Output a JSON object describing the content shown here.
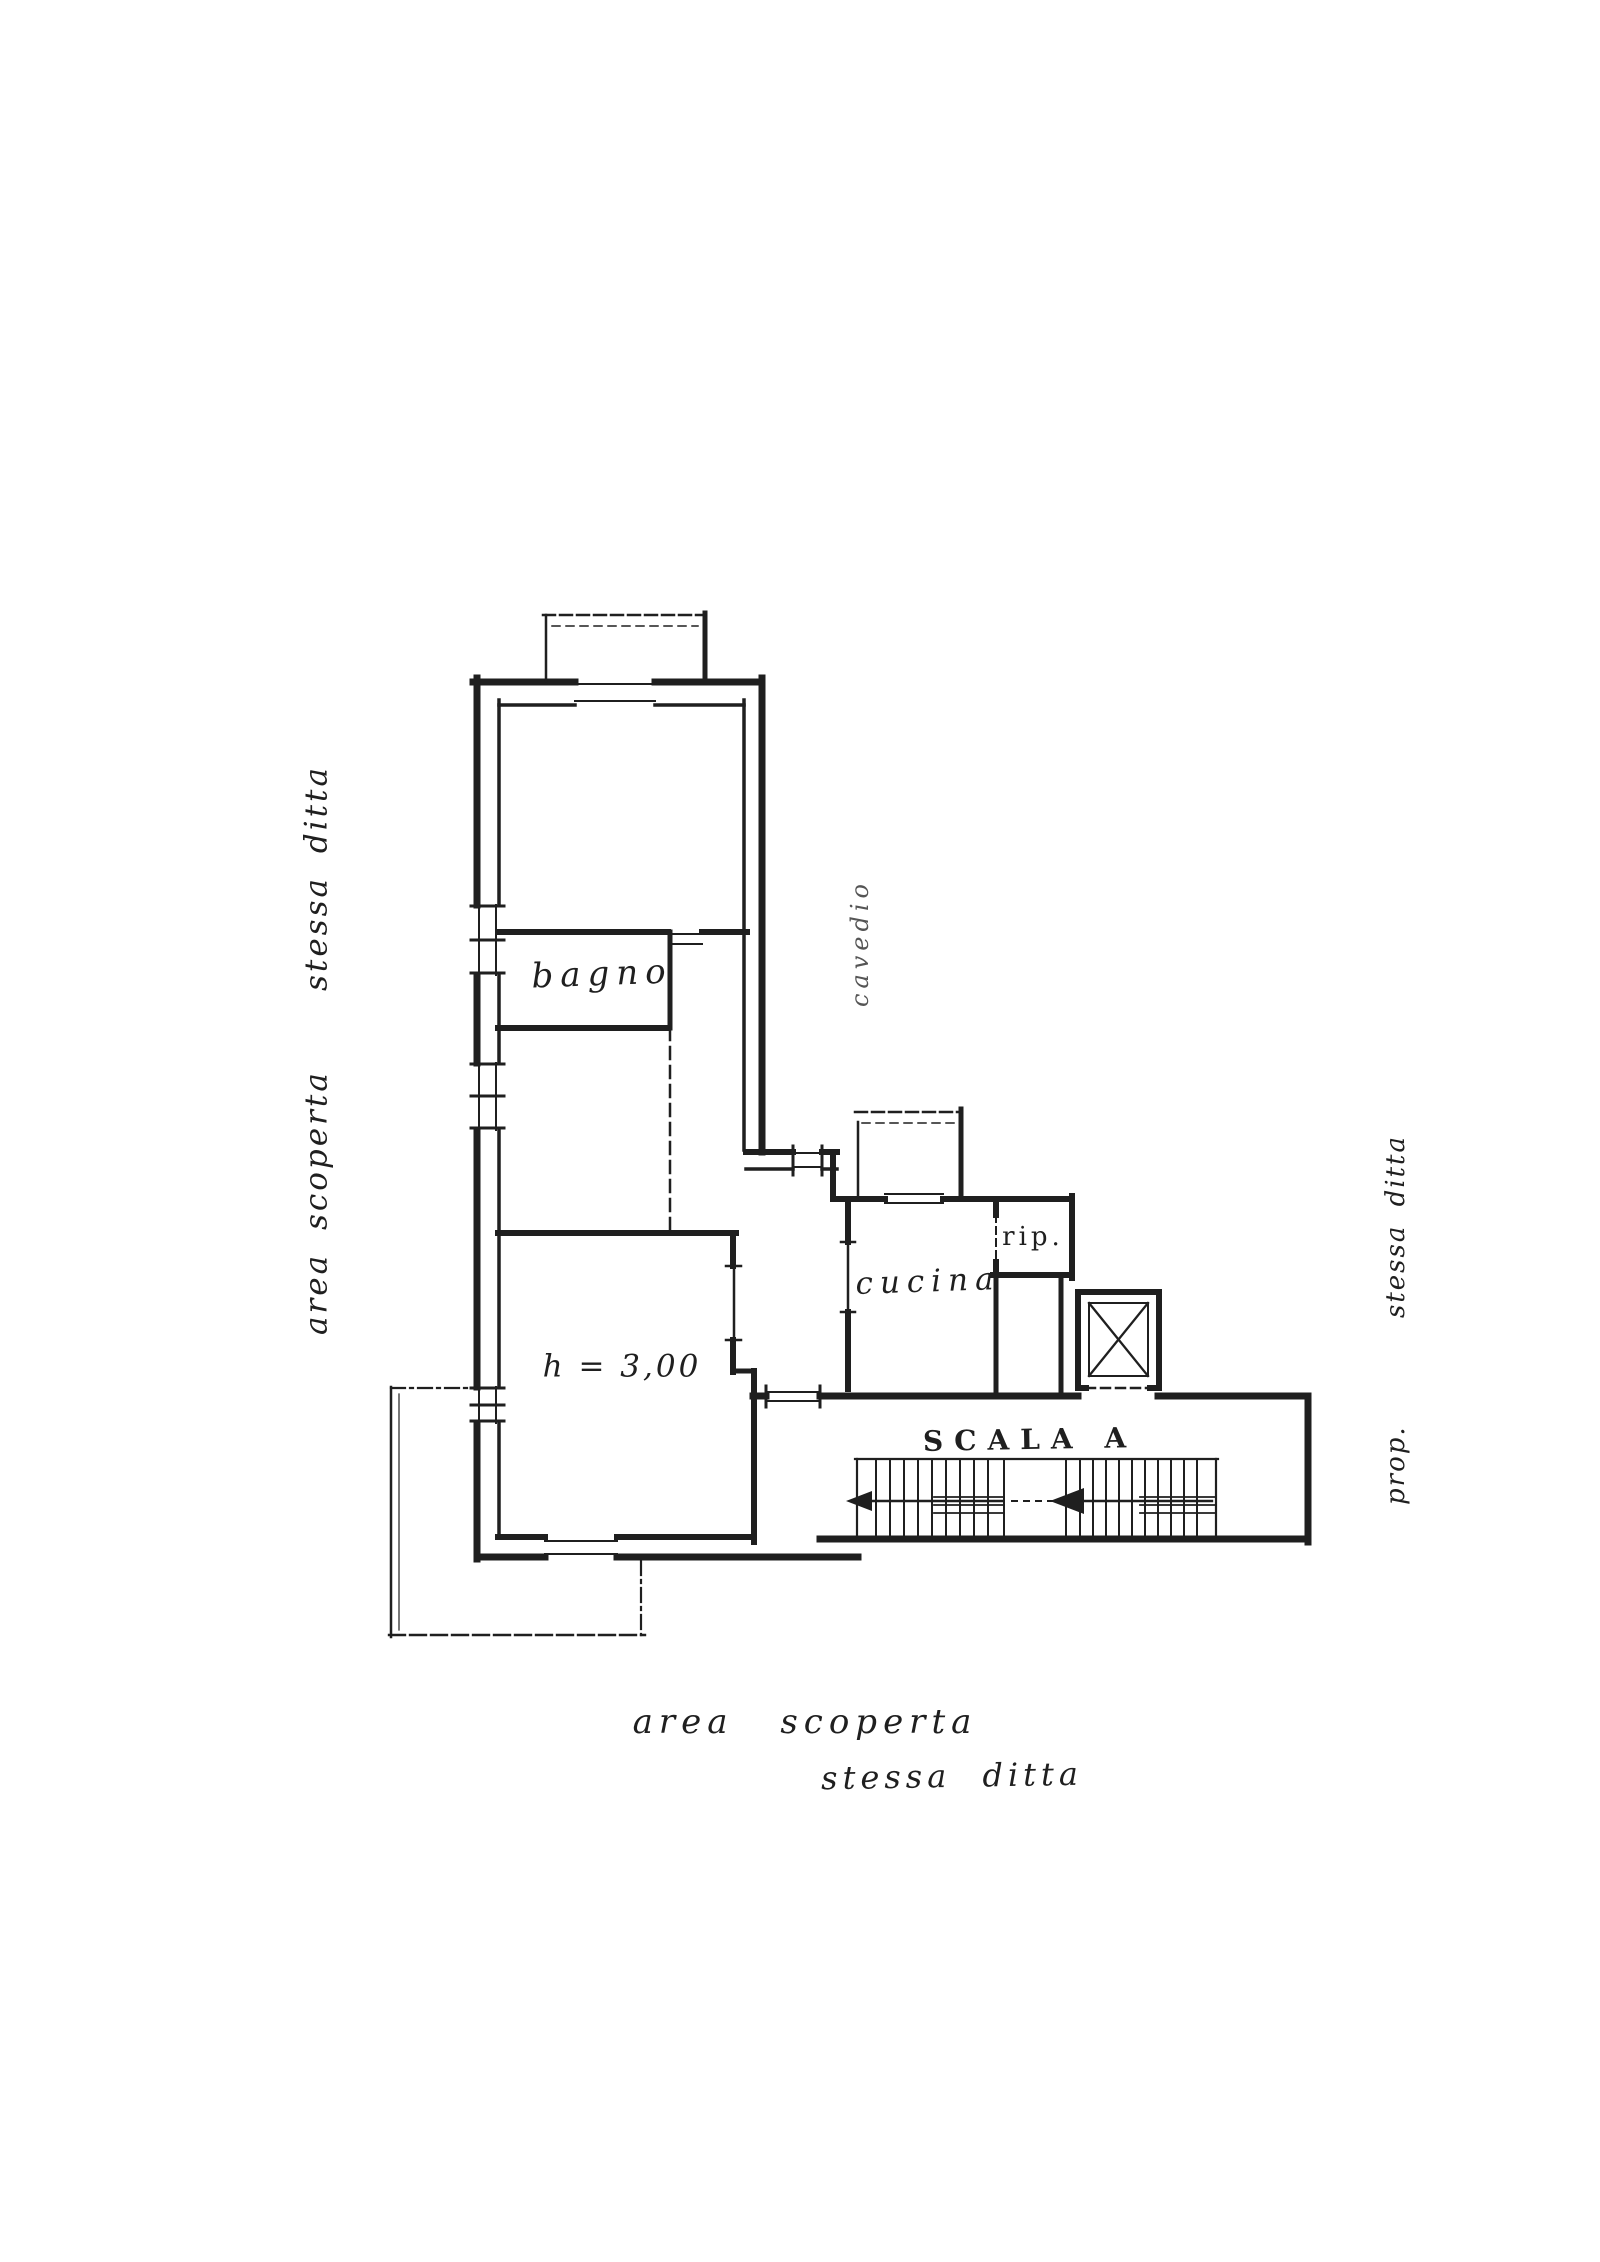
{
  "page": {
    "paper_color": "#ffffff",
    "ink_color": "#1f1f1f",
    "faint_ink_color": "#555555"
  },
  "margin_notes": {
    "left": {
      "line1": "area scoperta",
      "line2": "stessa ditta"
    },
    "right": {
      "line1": "prop.",
      "line2": "stessa ditta"
    },
    "bottom": {
      "line1": "area scoperta",
      "line2": "stessa ditta"
    }
  },
  "rooms": {
    "bagno": {
      "label": "bagno"
    },
    "cavedio": {
      "label": "cavedio"
    },
    "cucina": {
      "label": "cucina"
    },
    "ripostiglio": {
      "label": "rip."
    },
    "main_room": {
      "label": "h = 3,00"
    },
    "staircase": {
      "label": "SCALA A"
    }
  }
}
